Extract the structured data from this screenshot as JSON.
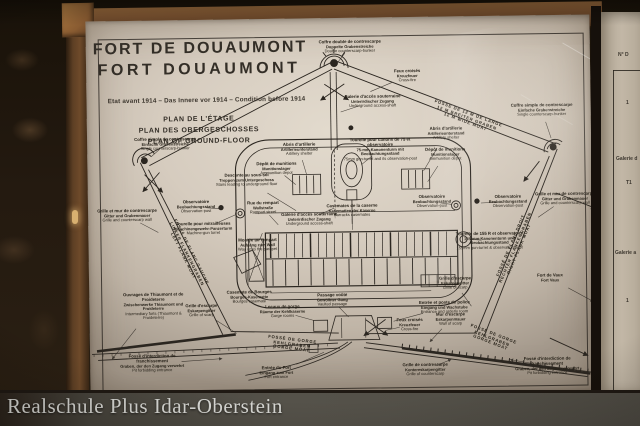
{
  "photo": {
    "caption": "Realschule Plus Idar-Oberstein"
  },
  "board": {
    "title_fr": "FORT DE DOUAUMONT",
    "title_de": "FORT DOUAUMONT",
    "subtitle": "Etat avant 1914  –  Das Innere vor 1914  –  Condition before 1914",
    "plan_line_fr": "PLAN DE L'ÉTAGE",
    "plan_line_de": "PLAN DES OBERGESCHOSSES",
    "plan_line_en": "PLAN OF GROUND-FLOOR"
  },
  "colors": {
    "panel": "#d6ccbf",
    "ink": "#2b2620",
    "wood": "#7a5230",
    "band": "#504d45",
    "caption_text": "#d8d8d4"
  },
  "side_panel": {
    "fragments": [
      {
        "t": "N° D",
        "x": 18,
        "y": 40
      },
      {
        "t": "1",
        "x": 26,
        "y": 88
      },
      {
        "t": "Galerie d",
        "x": 16,
        "y": 144
      },
      {
        "t": "T1",
        "x": 26,
        "y": 168
      },
      {
        "t": "Galerie a",
        "x": 15,
        "y": 238
      },
      {
        "t": "1",
        "x": 26,
        "y": 286
      }
    ]
  },
  "plan": {
    "ink": "#2b2620",
    "labels": [
      {
        "fr": "Coffre double de contrescarpe",
        "de": "Doppelte Grabenstreiche",
        "en": "Double counterscarp-bunker",
        "x": 352,
        "y": 47,
        "tx": 340,
        "ty": 62
      },
      {
        "fr": "Feux croisés",
        "de": "Kreuzfeuer",
        "en": "Cross-fire",
        "x": 409,
        "y": 77,
        "tx": 372,
        "ty": 92
      },
      {
        "fr": "Galerie d'accès souterraine",
        "de": "Unterirdischer Zugang",
        "en": "Underground access-shaft",
        "x": 374,
        "y": 102,
        "tx": 342,
        "ty": 112
      },
      {
        "fr": "FOSSÉ DE 12 M DE LARGE",
        "de": "12 M BREITER GRABEN",
        "en": "12 M WIDE MOAT",
        "x": 468,
        "y": 120,
        "rot": 21
      },
      {
        "fr": "Coffre simple de contrescarpe",
        "de": "Einfache Grabenstreiche",
        "en": "Single counterscarp-bunker",
        "x": 166,
        "y": 142,
        "tx": 152,
        "ty": 154
      },
      {
        "fr": "Coffre simple de contrescarpe",
        "de": "Einfache Grabenstreiche",
        "en": "Single counterscarp-bunker",
        "x": 543,
        "y": 113,
        "tx": 552,
        "ty": 141
      },
      {
        "fr": "Descente au sous-sol",
        "de": "Treppen zum Untergeschoss",
        "en": "Stairs leading to underground floor",
        "x": 247,
        "y": 179,
        "tx": 296,
        "ty": 210
      },
      {
        "fr": "Observatoire",
        "de": "Beobachtungsstand",
        "en": "Observation-post",
        "x": 196,
        "y": 205,
        "tx": 219,
        "ty": 207
      },
      {
        "fr": "Tourelle pour mitrailleuses",
        "de": "Maschinengewehr-Panzerturm",
        "en": "Machine-gun turret",
        "x": 203,
        "y": 227,
        "tx": 236,
        "ty": 213
      },
      {
        "fr": "Abris d'artillerie",
        "de": "Artillerieunterstand",
        "en": "Artillery shelter",
        "x": 300,
        "y": 149,
        "tx": 307,
        "ty": 174
      },
      {
        "fr": "Dépôt de munitions",
        "de": "Munitionslager",
        "en": "Ammunition depot",
        "x": 277,
        "y": 168,
        "tx": 296,
        "ty": 184
      },
      {
        "fr": "Tourelle pour canons de 75 et observatoire",
        "de": "75-mm-Kanonenturm mit Beobachtungsstand",
        "en": "75mm gun-turret and its observation-post",
        "x": 381,
        "y": 150,
        "tx": 362,
        "ty": 165
      },
      {
        "fr": "Abris d'artillerie",
        "de": "Artillerieunterstand",
        "en": "Artillery shelter",
        "x": 447,
        "y": 135,
        "tx": 424,
        "ty": 172
      },
      {
        "fr": "Dépôt de munitions",
        "de": "Munitionslager",
        "en": "Ammunition depot",
        "x": 446,
        "y": 156,
        "tx": 428,
        "ty": 183
      },
      {
        "fr": "Observatoire",
        "de": "Beobachtungsstand",
        "en": "Observation-post",
        "x": 432,
        "y": 203,
        "tx": 452,
        "ty": 206
      },
      {
        "fr": "Observatoire",
        "de": "Beobachtungsstand",
        "en": "Observation-post",
        "x": 508,
        "y": 204,
        "tx": 481,
        "ty": 205
      },
      {
        "fr": "Grille et mur de contrescarpe",
        "de": "Gitter und Grabenmauer",
        "en": "Grille and counterscarp wall",
        "x": 127,
        "y": 213,
        "tx": 158,
        "ty": 230
      },
      {
        "fr": "Grille et mur de contrescarpe",
        "de": "Gitter und Grabenmauer",
        "en": "Grille and counterscarp wall",
        "x": 565,
        "y": 202,
        "tx": 538,
        "ty": 220
      },
      {
        "fr": "FOSSÉ DE FLANC GAUCHE",
        "de": "LINKER FLANKENGRABEN",
        "en": "LEFT FLANK MOAT",
        "x": 186,
        "y": 252,
        "rot": 64
      },
      {
        "fr": "FOSSÉ DE FLANC DROIT",
        "de": "RECHTER FLANKENGRABEN",
        "en": "RIGHT FLANK MOAT",
        "x": 515,
        "y": 250,
        "rot": -66
      },
      {
        "fr": "Tourelle de 155 R et observatoire",
        "de": "155-mm-Kanonenturm und Beobachtungsstand",
        "en": "155mm gun-turret & observation-post",
        "x": 489,
        "y": 243,
        "tx": 470,
        "ty": 241
      },
      {
        "fr": "Rue du rempart",
        "de": "Wallstraße",
        "en": "Rampart street",
        "x": 263,
        "y": 207,
        "tx": 278,
        "ty": 224
      },
      {
        "fr": "Galerie d'accès souterraine",
        "de": "Unterirdischer Zugang",
        "en": "Underground access-shaft",
        "x": 309,
        "y": 219,
        "tx": 334,
        "ty": 208
      },
      {
        "fr": "Casemates de la caserne",
        "de": "Kasematten der Kaserne",
        "en": "Barracks casemates",
        "x": 352,
        "y": 211,
        "tx": 352,
        "ty": 230
      },
      {
        "fr": "Montée au rempart",
        "de": "Aufgang zum Wall",
        "en": "Way up to the parapet",
        "x": 257,
        "y": 244,
        "tx": 262,
        "ty": 232
      },
      {
        "fr": "Casemate de Bourges",
        "de": "Bourges-Kasematte",
        "en": "Bourges casemate",
        "x": 248,
        "y": 296,
        "tx": 246,
        "ty": 268
      },
      {
        "fr": "Locaux de gorge",
        "de": "Räume der Kehlkaserne",
        "en": "Gorge rooms",
        "x": 281,
        "y": 311,
        "tx": 312,
        "ty": 320
      },
      {
        "fr": "Passage voûté",
        "de": "Gewölbter Gang",
        "en": "Vaulted passage",
        "x": 331,
        "y": 300,
        "tx": 347,
        "ty": 317
      },
      {
        "fr": "Feux croisés",
        "de": "Kreuzfeuer",
        "en": "Cross-fire",
        "x": 408,
        "y": 326,
        "tx": 384,
        "ty": 331
      },
      {
        "fr": "Entrée et poste de police",
        "de": "Eingang und Wachstube",
        "en": "Entrance and orderly room",
        "x": 443,
        "y": 309,
        "tx": 392,
        "ty": 322
      },
      {
        "fr": "FOSSÉ DE GORGE",
        "de": "KEHLGRABEN",
        "en": "GORGE MOAT",
        "x": 290,
        "y": 344,
        "rot": 8
      },
      {
        "fr": "FOSSÉ DE GORGE",
        "de": "KEHLGRABEN",
        "en": "GORGE MOAT",
        "x": 490,
        "y": 341,
        "rot": 22
      },
      {
        "fr": "Entrée du Fort",
        "de": "Eingang zum Fort",
        "en": "Fort entrance",
        "x": 274,
        "y": 372,
        "tx": 322,
        "ty": 352
      },
      {
        "fr": "Fossé d'interdiction de franchissement",
        "de": "Graben, der den Zugang verwehrt",
        "en": "Pit forbidding entrance",
        "x": 150,
        "y": 361,
        "tx": 220,
        "ty": 357,
        "arrow": true
      },
      {
        "fr": "Fossé d'interdiction de franchissement",
        "de": "Graben, der den Zugang verwehrt",
        "en": "Pit forbidding entrance",
        "x": 545,
        "y": 369,
        "tx": 508,
        "ty": 362,
        "arrow": true
      },
      {
        "fr": "Grille d'escarpe",
        "de": "Eskarpengitter",
        "en": "Grille of scarp",
        "x": 200,
        "y": 309,
        "tx": 235,
        "ty": 332
      },
      {
        "fr": "Grille d'escarpe",
        "de": "Eskarpengitter",
        "en": "Grille of scarp",
        "x": 454,
        "y": 285,
        "tx": 470,
        "ty": 308
      },
      {
        "fr": "Mur d'escarpe",
        "de": "Eskarpenmauer",
        "en": "Wall of scarp",
        "x": 449,
        "y": 321,
        "tx": 428,
        "ty": 343,
        "arrow": true
      },
      {
        "fr": "Grille de contrescarpe",
        "de": "Kontereskarpengitter",
        "en": "Grille of counterscarp",
        "x": 423,
        "y": 371,
        "tx": 449,
        "ty": 361,
        "arrow": true
      },
      {
        "fr": "Fort de Vaux",
        "de": "Fort Vaux",
        "en": "",
        "x": 549,
        "y": 281,
        "tx": 592,
        "ty": 305,
        "arrow": true
      },
      {
        "fr": "Ouvrages de Thiaumont et de Froideterre",
        "de": "Zwischenwerke Thiaumont und Froideterre",
        "en": "Intermediary forts (Thiaumont & Froideterre)",
        "x": 152,
        "y": 304,
        "tx": 110,
        "ty": 356,
        "arrow": true
      }
    ]
  }
}
